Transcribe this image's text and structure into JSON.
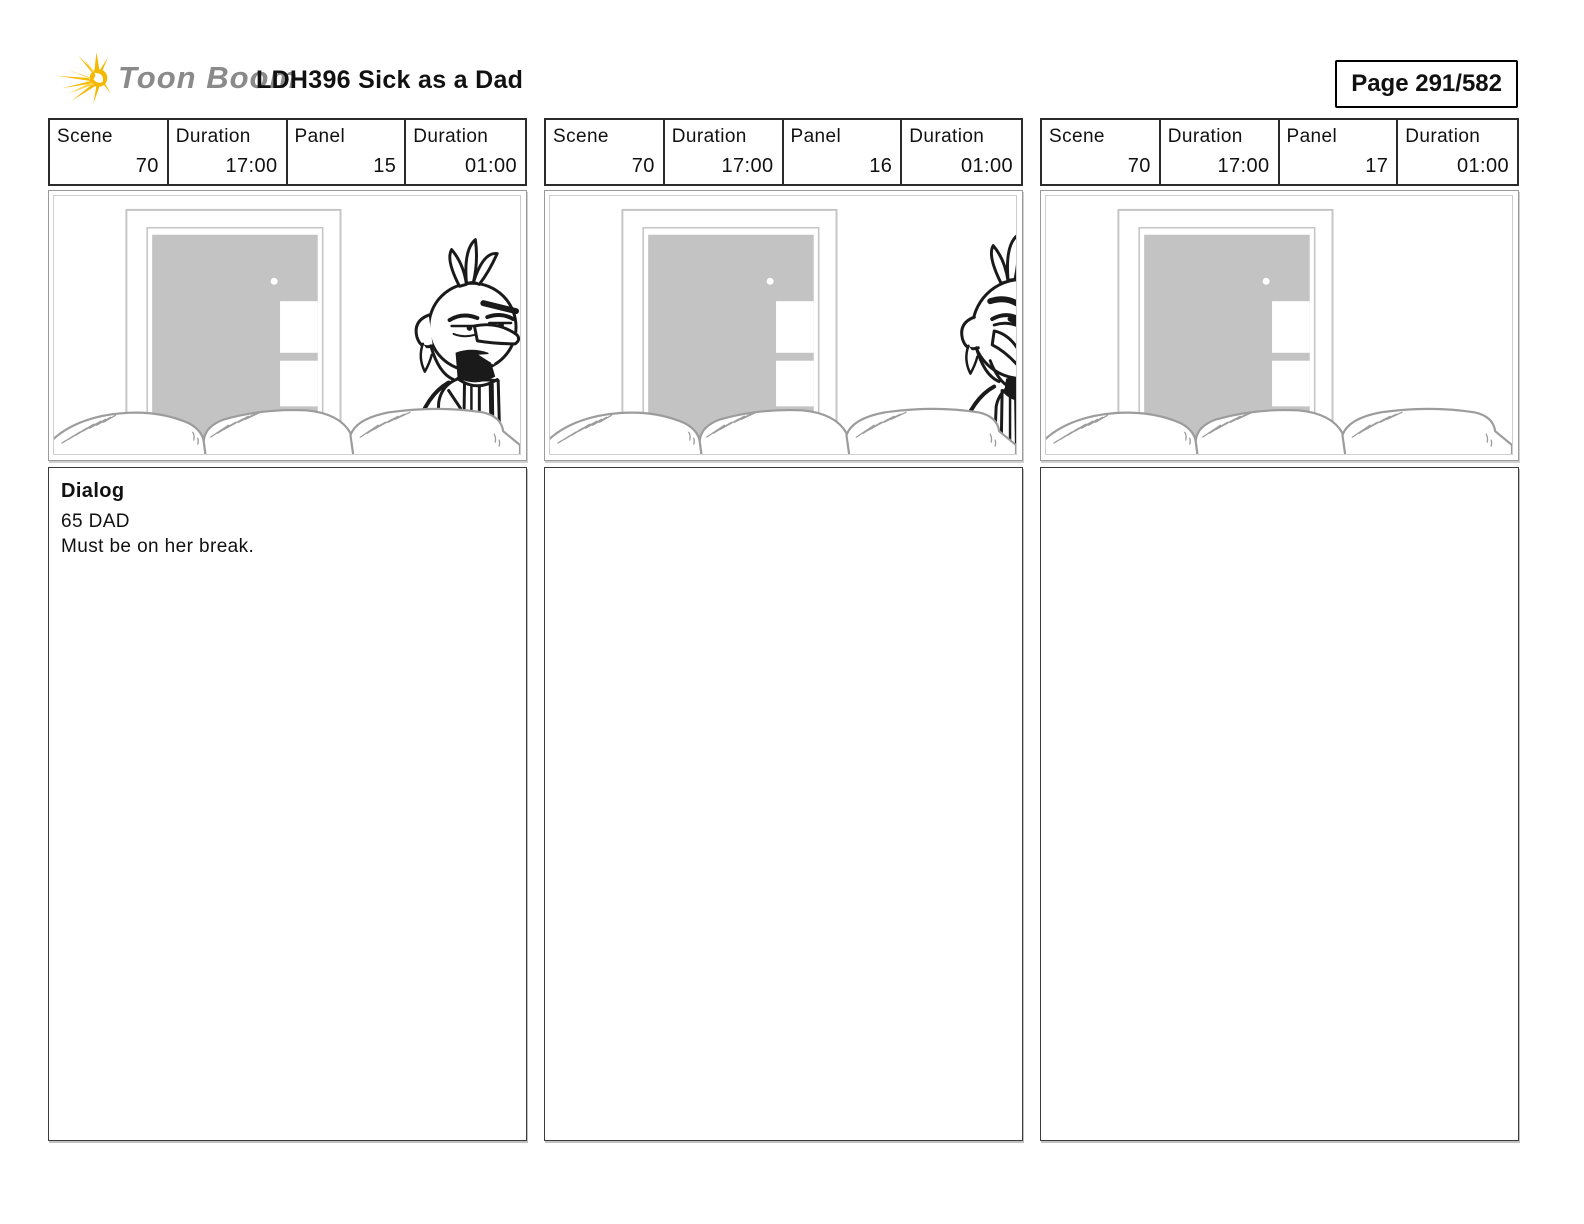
{
  "header": {
    "brand": "Toon Boom",
    "title": "LDH396 Sick as a Dad",
    "page_indicator": "Page 291/582"
  },
  "labels": {
    "scene": "Scene",
    "duration": "Duration",
    "panel": "Panel"
  },
  "panels": [
    {
      "scene": "70",
      "scene_duration": "17:00",
      "panel_number": "15",
      "panel_duration": "01:00",
      "caption": {
        "title": "Dialog",
        "body": "65 DAD\nMust be on her break."
      },
      "image": {
        "character": "full"
      }
    },
    {
      "scene": "70",
      "scene_duration": "17:00",
      "panel_number": "16",
      "panel_duration": "01:00",
      "caption": {
        "title": "",
        "body": ""
      },
      "image": {
        "character": "cropped"
      }
    },
    {
      "scene": "70",
      "scene_duration": "17:00",
      "panel_number": "17",
      "panel_duration": "01:00",
      "caption": {
        "title": "",
        "body": ""
      },
      "image": {
        "character": "none"
      }
    }
  ],
  "colors": {
    "door_fill": "#c3c3c3",
    "background_line": "#c6c6c6",
    "couch_line": "#9c9c9c",
    "ink": "#1a1a1a",
    "logo_yellow": "#f5b800",
    "logo_yellow_light": "#ffd24a",
    "logo_text_gray": "#8a8a8a"
  }
}
